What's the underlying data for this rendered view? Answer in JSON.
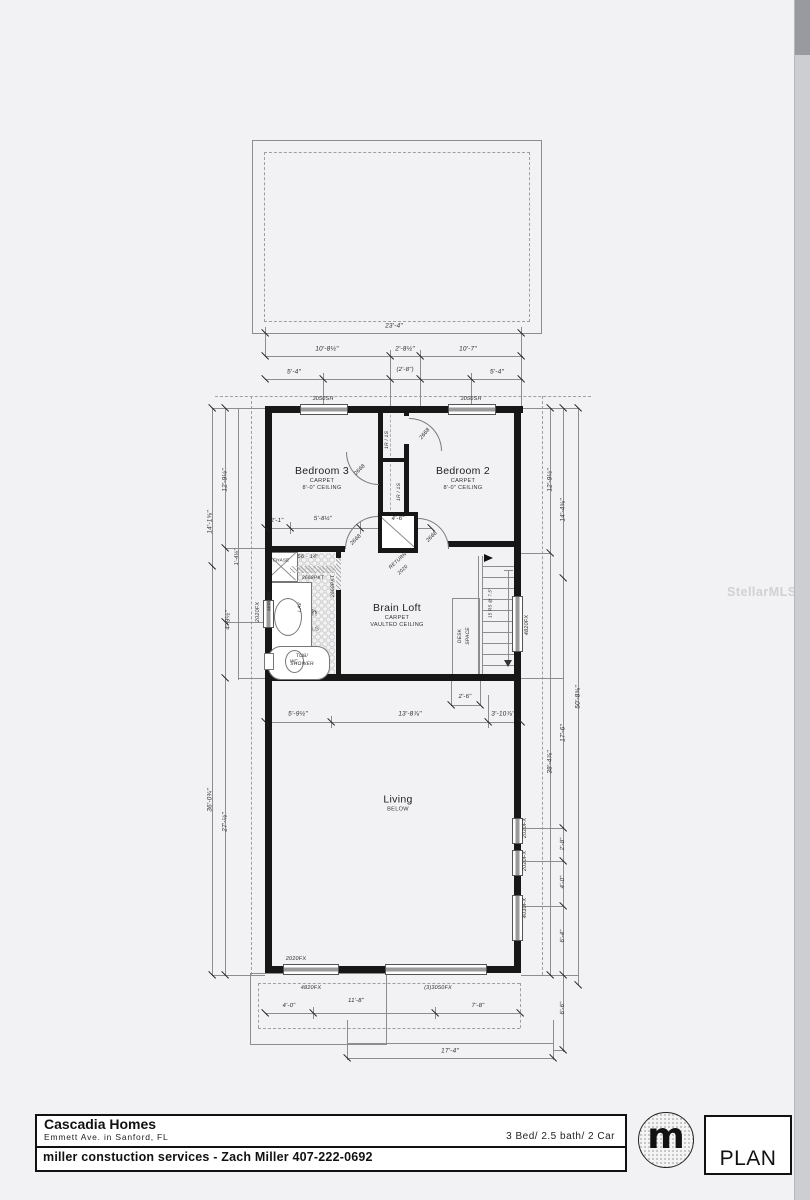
{
  "watermark": "StellarMLS",
  "title_block": {
    "company": "Cascadia Homes",
    "address": "Emmett Ave. in Sanford, FL",
    "specs": "3 Bed/ 2.5 bath/ 2 Car",
    "contractor": "miller constuction services - Zach Miller 407-222-0692",
    "logo_letter": "m",
    "sheet_name": "PLAN"
  },
  "rooms": {
    "bedroom3": {
      "name": "Bedroom 3",
      "finish": "CARPET",
      "ceiling": "8'-0\" CEILING"
    },
    "bedroom2": {
      "name": "Bedroom 2",
      "finish": "CARPET",
      "ceiling": "8'-0\" CEILING"
    },
    "bath": {
      "name": "Bath",
      "finish": "TILE",
      "ceiling": "8'-0\" CLG"
    },
    "loft": {
      "name": "Brain Loft",
      "finish": "CARPET",
      "ceiling": "VAULTED CEILING"
    },
    "living": {
      "name": "Living",
      "note": "BELOW"
    }
  },
  "labels": [
    {
      "n": "dim-overall-width",
      "t": "23'-4\"",
      "x": 394,
      "y": 326
    },
    {
      "n": "dim-top-left",
      "t": "10'-8½\"",
      "x": 327,
      "y": 349
    },
    {
      "n": "dim-top-mid",
      "t": "2'-8½\"",
      "x": 405,
      "y": 349
    },
    {
      "n": "dim-top-right",
      "t": "10'-7\"",
      "x": 468,
      "y": 349
    },
    {
      "n": "dim-win-left",
      "t": "5'-4\"",
      "x": 294,
      "y": 372
    },
    {
      "n": "dim-hall",
      "t": "(2'-8\")",
      "x": 405,
      "y": 370,
      "s": 6
    },
    {
      "n": "dim-win-right",
      "t": "5'-4\"",
      "x": 497,
      "y": 372
    },
    {
      "n": "window-3050sh-left",
      "t": "3050SH",
      "x": 323,
      "y": 399,
      "s": 5.5
    },
    {
      "n": "window-3050sh-right",
      "t": "3050SH",
      "x": 471,
      "y": 399,
      "s": 5.5
    },
    {
      "n": "dim-left-bed3",
      "t": "12'-9½\"",
      "x": 225,
      "y": 480,
      "r": -90
    },
    {
      "n": "dim-left-upper",
      "t": "14'-1⅝\"",
      "x": 210,
      "y": 522,
      "r": -90
    },
    {
      "n": "dim-left-jog",
      "t": "1'-4⅛\"",
      "x": 237,
      "y": 557,
      "r": -90,
      "s": 5.5
    },
    {
      "n": "dim-left-bath",
      "t": "4'-9½\"",
      "x": 228,
      "y": 620,
      "r": -90
    },
    {
      "n": "window-2020fx-bath",
      "t": "2020FX",
      "x": 258,
      "y": 612,
      "r": -90,
      "s": 5.5
    },
    {
      "n": "dim-left-lower",
      "t": "36'-0¾\"",
      "x": 210,
      "y": 800,
      "r": -90
    },
    {
      "n": "dim-left-living",
      "t": "27'-½\"",
      "x": 225,
      "y": 822,
      "r": -90
    },
    {
      "n": "dim-right-bed2",
      "t": "12'-9½\"",
      "x": 550,
      "y": 480,
      "r": -90
    },
    {
      "n": "dim-right-upper",
      "t": "14'-4⅝\"",
      "x": 563,
      "y": 510,
      "r": -90
    },
    {
      "n": "dim-right-mid",
      "t": "17'-6\"",
      "x": 563,
      "y": 733,
      "r": -90
    },
    {
      "n": "dim-right-lower",
      "t": "38'-4⅞\"",
      "x": 550,
      "y": 762,
      "r": -90
    },
    {
      "n": "dim-right-overall",
      "t": "50'-8⅝\"",
      "x": 578,
      "y": 697,
      "r": -90
    },
    {
      "n": "dim-right-w1",
      "t": "2'-8\"",
      "x": 563,
      "y": 844,
      "r": -90,
      "s": 6
    },
    {
      "n": "dim-right-w2",
      "t": "4'-0\"",
      "x": 563,
      "y": 882,
      "r": -90,
      "s": 6
    },
    {
      "n": "dim-right-w3",
      "t": "6'-4\"",
      "x": 563,
      "y": 936,
      "r": -90,
      "s": 6
    },
    {
      "n": "dim-right-porch",
      "t": "6'-6\"",
      "x": 563,
      "y": 1008,
      "r": -90,
      "s": 6
    },
    {
      "n": "window-4820fx-stair",
      "t": "4820FX",
      "x": 527,
      "y": 625,
      "r": -90,
      "s": 5.5
    },
    {
      "n": "window-2020fx-living1",
      "t": "2020FX",
      "x": 525,
      "y": 828,
      "r": -90,
      "s": 5.5
    },
    {
      "n": "window-2020fx-living2",
      "t": "2020FX",
      "x": 525,
      "y": 861,
      "r": -90,
      "s": 5.5
    },
    {
      "n": "window-4030fx-living",
      "t": "4030FX",
      "x": 525,
      "y": 908,
      "r": -90,
      "s": 5.5
    },
    {
      "n": "dim-bath-1",
      "t": "2'-1\"",
      "x": 277,
      "y": 521,
      "s": 6
    },
    {
      "n": "dim-bath-2",
      "t": "5'-8½\"",
      "x": 323,
      "y": 519,
      "s": 6
    },
    {
      "n": "dim-bath-3",
      "t": "4'-6\"",
      "x": 398,
      "y": 519,
      "s": 6
    },
    {
      "n": "dim-niche",
      "t": "56 - 14\"",
      "x": 308,
      "y": 557,
      "s": 5.5
    },
    {
      "n": "door-bath-pocket-h",
      "t": "2668PKT",
      "x": 313,
      "y": 578,
      "s": 5
    },
    {
      "n": "door-bath-pocket-v",
      "t": "2668PKT",
      "x": 333,
      "y": 586,
      "r": -90,
      "s": 5
    },
    {
      "n": "chase-label",
      "t": "CHASE",
      "x": 281,
      "y": 560,
      "s": 4.5
    },
    {
      "n": "mirror-label",
      "t": "MIRROR",
      "x": 269,
      "y": 601,
      "r": -90,
      "s": 4.5
    },
    {
      "n": "lav-label",
      "t": "LAV",
      "x": 300,
      "y": 607,
      "r": -90,
      "s": 5
    },
    {
      "n": "wc-label",
      "t": "WC",
      "x": 294,
      "y": 661,
      "s": 4.5
    },
    {
      "n": "tub-label-1",
      "t": "TUB/",
      "x": 302,
      "y": 656,
      "s": 5
    },
    {
      "n": "tub-label-2",
      "t": "SHOWER",
      "x": 302,
      "y": 664,
      "s": 5
    },
    {
      "n": "return-label",
      "t": "RETURN",
      "x": 398,
      "y": 561,
      "r": -42,
      "s": 5
    },
    {
      "n": "return-size",
      "t": "2020",
      "x": 403,
      "y": 570,
      "r": -42,
      "s": 5
    },
    {
      "n": "closet-top-label",
      "t": "1R / 1S",
      "x": 387,
      "y": 440,
      "r": -90,
      "s": 5
    },
    {
      "n": "closet-bottom-label",
      "t": "1R / 1S",
      "x": 399,
      "y": 492,
      "r": -90,
      "s": 5
    },
    {
      "n": "door-closet-top",
      "t": "2668",
      "x": 425,
      "y": 434,
      "r": -50,
      "s": 5.5
    },
    {
      "n": "door-closet-bottom",
      "t": "2668",
      "x": 360,
      "y": 470,
      "r": -45,
      "s": 5.5
    },
    {
      "n": "door-bed3",
      "t": "2668",
      "x": 356,
      "y": 540,
      "r": -45,
      "s": 5.5
    },
    {
      "n": "door-bed2",
      "t": "2668",
      "x": 432,
      "y": 537,
      "r": -45,
      "s": 5.5
    },
    {
      "n": "desk-label-1",
      "t": "DESK",
      "x": 460,
      "y": 636,
      "r": -90,
      "s": 5
    },
    {
      "n": "desk-label-2",
      "t": "SPACE",
      "x": 468,
      "y": 636,
      "r": -90,
      "s": 5
    },
    {
      "n": "stair-note",
      "t": "15 RS @ 7.5\"",
      "x": 490,
      "y": 603,
      "r": -90,
      "s": 4.5
    },
    {
      "n": "dim-stair",
      "t": "2'-6\"",
      "x": 465,
      "y": 697,
      "s": 6
    },
    {
      "n": "dim-loft-1",
      "t": "5'-9½\"",
      "x": 298,
      "y": 714
    },
    {
      "n": "dim-loft-2",
      "t": "13'-8⅞\"",
      "x": 410,
      "y": 714
    },
    {
      "n": "dim-loft-3",
      "t": "3'-10⅞\"",
      "x": 503,
      "y": 714
    },
    {
      "n": "window-2020fx-bottom",
      "t": "2020FX",
      "x": 296,
      "y": 959,
      "s": 5.5
    },
    {
      "n": "window-4820fx-bottom",
      "t": "4820FX",
      "x": 311,
      "y": 988,
      "s": 5.5
    },
    {
      "n": "window-3050fx-bottom",
      "t": "(3)3050FX",
      "x": 438,
      "y": 988,
      "s": 5.5
    },
    {
      "n": "dim-bottom-1",
      "t": "4'-0\"",
      "x": 289,
      "y": 1006,
      "s": 6
    },
    {
      "n": "dim-bottom-2",
      "t": "11'-8\"",
      "x": 356,
      "y": 1001,
      "s": 6
    },
    {
      "n": "dim-bottom-3",
      "t": "7'-8\"",
      "x": 478,
      "y": 1006,
      "s": 6
    },
    {
      "n": "dim-porch",
      "t": "17'-4\"",
      "x": 450,
      "y": 1051
    }
  ]
}
